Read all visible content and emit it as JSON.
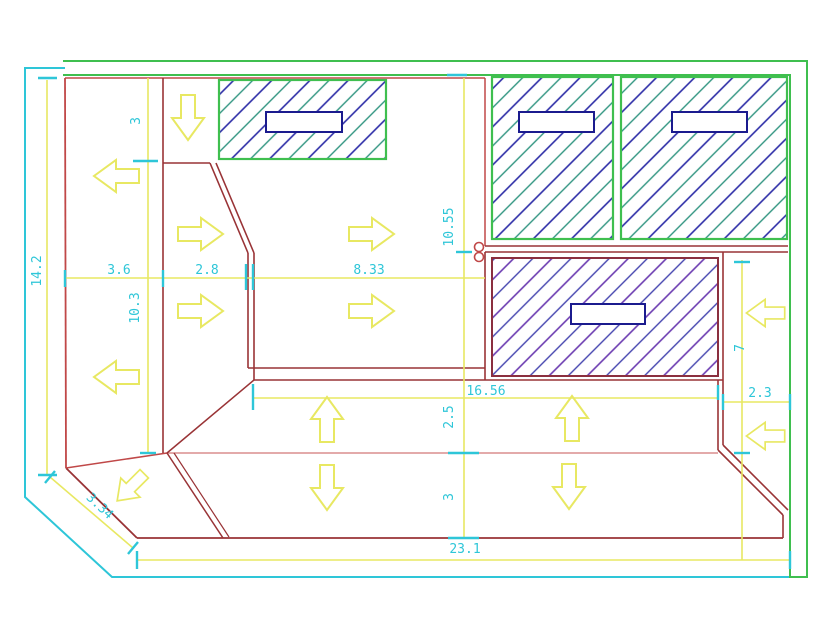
{
  "drawing": {
    "title": "roof-slope-plan",
    "dims": {
      "dim_3_upper": "3",
      "dim_3_6": "3.6",
      "dim_2_8": "2.8",
      "dim_8_33": "8.33",
      "dim_14_2": "14.2",
      "dim_10_3": "10.3",
      "dim_10_55": "10.55",
      "dim_16_56": "16.56",
      "dim_2_5": "2.5",
      "dim_3_lower": "3",
      "dim_23_1": "23.1",
      "dim_3_34": "3.34",
      "dim_2_3": "2.3",
      "dim_7": "7"
    },
    "label_boxes": [
      {
        "text": ""
      },
      {
        "text": ""
      },
      {
        "text": ""
      },
      {
        "text": ""
      }
    ],
    "arrows": [
      {
        "direction": "down"
      },
      {
        "direction": "left"
      },
      {
        "direction": "right"
      },
      {
        "direction": "right"
      },
      {
        "direction": "right"
      },
      {
        "direction": "right"
      },
      {
        "direction": "left"
      },
      {
        "direction": "up"
      },
      {
        "direction": "up"
      },
      {
        "direction": "left"
      },
      {
        "direction": "left"
      },
      {
        "direction": "down"
      },
      {
        "direction": "down"
      },
      {
        "direction": "down-left"
      }
    ],
    "icons": {
      "pipe_marker": "double-circle-marker"
    },
    "colors": {
      "boundary_cyan": "#2ec6d8",
      "border_green": "#3fbf4f",
      "dimension_yellow": "#e8e862",
      "plan_red": "#c04848",
      "plan_red_dark": "#993336",
      "plan_red_light": "#da8d8d",
      "hatch_indigo": "#2b2ba6",
      "hatch_teal": "#2f9480",
      "hatch_purple": "#6a3ab0",
      "hatch_blue": "#4343ae",
      "label_box_border": "#1b1b8e",
      "background": "#ffffff"
    }
  }
}
